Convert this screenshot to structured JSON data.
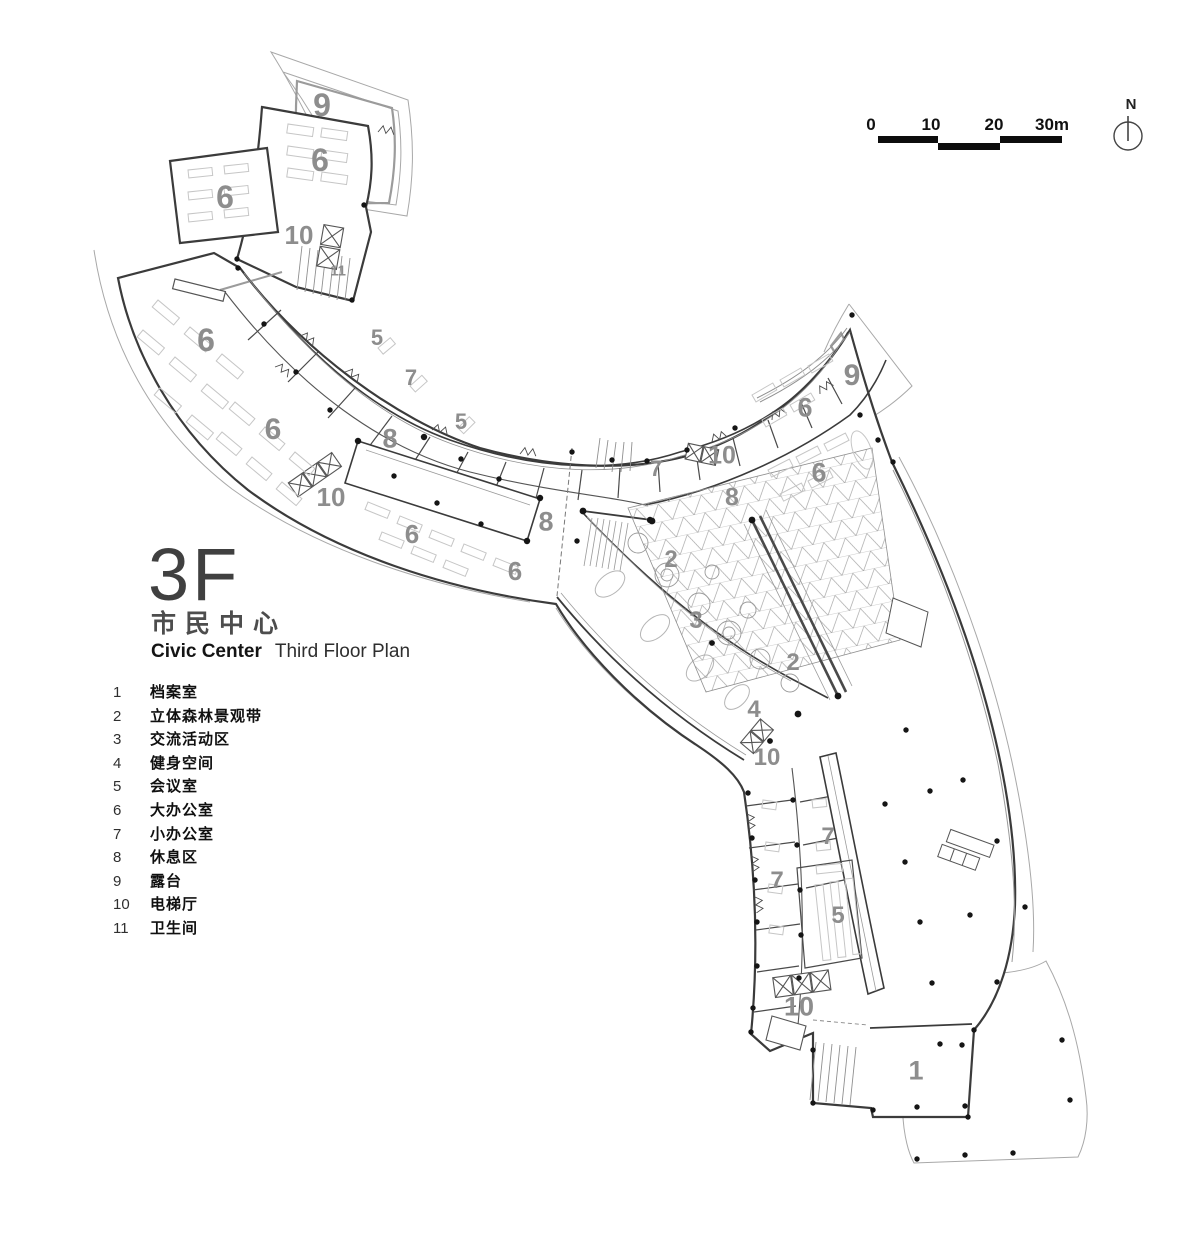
{
  "header": {
    "floor": "3F",
    "building_cn": "市民中心",
    "building_en": "Civic Center",
    "plan_title_en": "Third Floor Plan"
  },
  "legend": {
    "items": [
      {
        "num": "1",
        "label": "档案室"
      },
      {
        "num": "2",
        "label": "立体森林景观带"
      },
      {
        "num": "3",
        "label": "交流活动区"
      },
      {
        "num": "4",
        "label": "健身空间"
      },
      {
        "num": "5",
        "label": "会议室"
      },
      {
        "num": "6",
        "label": "大办公室"
      },
      {
        "num": "7",
        "label": "小办公室"
      },
      {
        "num": "8",
        "label": "休息区"
      },
      {
        "num": "9",
        "label": "露台"
      },
      {
        "num": "10",
        "label": "电梯厅"
      },
      {
        "num": "11",
        "label": "卫生间"
      }
    ]
  },
  "scale_bar": {
    "ticks": [
      {
        "text": "0",
        "x": 871
      },
      {
        "text": "10",
        "x": 931
      },
      {
        "text": "20",
        "x": 994
      },
      {
        "text": "30m",
        "x": 1052
      }
    ],
    "bars": [
      {
        "left": 878,
        "top": 136,
        "width": 60
      },
      {
        "left": 938,
        "top": 143,
        "width": 62
      },
      {
        "left": 1000,
        "top": 136,
        "width": 62
      }
    ]
  },
  "north_arrow": {
    "label": "N"
  },
  "plan_labels": [
    {
      "t": "9",
      "x": 322,
      "y": 105,
      "s": 32
    },
    {
      "t": "6",
      "x": 320,
      "y": 160,
      "s": 32
    },
    {
      "t": "6",
      "x": 225,
      "y": 197,
      "s": 32
    },
    {
      "t": "10",
      "x": 299,
      "y": 235,
      "s": 26
    },
    {
      "t": "11",
      "x": 338,
      "y": 271,
      "s": 15
    },
    {
      "t": "6",
      "x": 206,
      "y": 340,
      "s": 32
    },
    {
      "t": "5",
      "x": 377,
      "y": 338,
      "s": 22
    },
    {
      "t": "7",
      "x": 411,
      "y": 378,
      "s": 22
    },
    {
      "t": "8",
      "x": 390,
      "y": 439,
      "s": 27
    },
    {
      "t": "5",
      "x": 461,
      "y": 422,
      "s": 22
    },
    {
      "t": "6",
      "x": 273,
      "y": 430,
      "s": 30
    },
    {
      "t": "10",
      "x": 331,
      "y": 497,
      "s": 26
    },
    {
      "t": "8",
      "x": 546,
      "y": 522,
      "s": 27
    },
    {
      "t": "6",
      "x": 412,
      "y": 534,
      "s": 26
    },
    {
      "t": "6",
      "x": 515,
      "y": 571,
      "s": 26
    },
    {
      "t": "7",
      "x": 656,
      "y": 469,
      "s": 22
    },
    {
      "t": "10",
      "x": 722,
      "y": 456,
      "s": 25
    },
    {
      "t": "8",
      "x": 732,
      "y": 498,
      "s": 25
    },
    {
      "t": "6",
      "x": 805,
      "y": 408,
      "s": 27
    },
    {
      "t": "9",
      "x": 852,
      "y": 376,
      "s": 30
    },
    {
      "t": "6",
      "x": 819,
      "y": 473,
      "s": 27
    },
    {
      "t": "2",
      "x": 671,
      "y": 560,
      "s": 24
    },
    {
      "t": "3",
      "x": 696,
      "y": 621,
      "s": 24
    },
    {
      "t": "2",
      "x": 793,
      "y": 663,
      "s": 24
    },
    {
      "t": "4",
      "x": 754,
      "y": 710,
      "s": 24
    },
    {
      "t": "10",
      "x": 767,
      "y": 758,
      "s": 24
    },
    {
      "t": "7",
      "x": 828,
      "y": 837,
      "s": 24
    },
    {
      "t": "7",
      "x": 777,
      "y": 881,
      "s": 24
    },
    {
      "t": "5",
      "x": 838,
      "y": 916,
      "s": 24
    },
    {
      "t": "10",
      "x": 799,
      "y": 1007,
      "s": 27
    },
    {
      "t": "1",
      "x": 916,
      "y": 1071,
      "s": 27
    }
  ],
  "colors": {
    "wall": "#3b3b3b",
    "thin_outline": "#a8a8a8",
    "furniture": "#c6c6c6",
    "room_label": "#8d8d8d",
    "scale_bar": "#0d0d0d"
  }
}
